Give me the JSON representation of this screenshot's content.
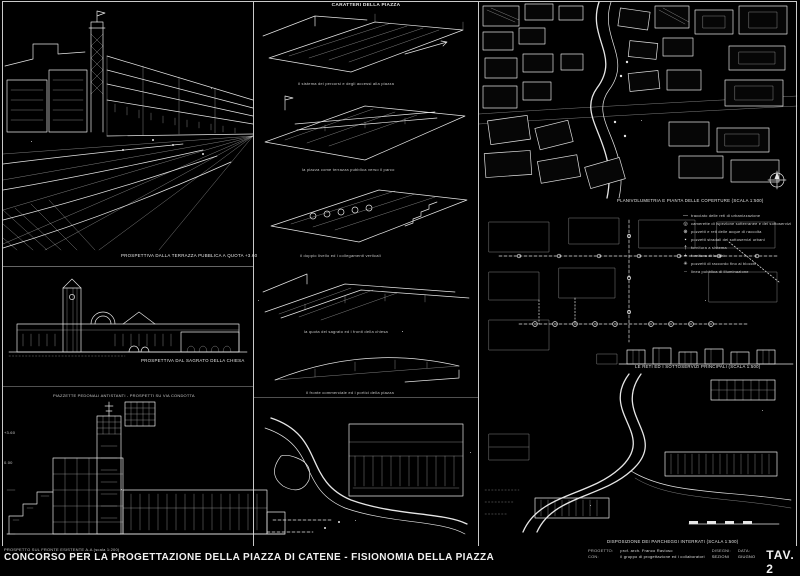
{
  "colors": {
    "background": "#000000",
    "ink": "#e6e6e6"
  },
  "middle_column": {
    "header": "CARATTERI DELLA PIAZZA",
    "sketch_captions": [
      "il sistema dei percorsi e degli accessi alla piazza",
      "la piazza come terrazza pubblica verso il parco",
      "il doppio livello ed i collegamenti verticali",
      "la quota del sagrato ed i fronti della chiesa",
      "il fronte commerciale ed i portici della piazza"
    ]
  },
  "left_column": {
    "perspective_caption": "PROSPETTIVA DALLA TERRAZZA PUBBLICA A QUOTA +3.60",
    "church_caption": "PROSPETTIVA DAL SAGRATO DELLA CHIESA",
    "elevation_note": "PIAZZETTE PEDONALI ANTISTANTI - PROSPETTI SU VIA CONDOTTA",
    "level_marks": [
      "+3.60",
      "0.00"
    ]
  },
  "right_column": {
    "map_caption": "PLANIVOLUMETRIA E PIANTA DELLE COPERTURE (scala 1:500)",
    "legend_items": [
      {
        "symbol": "—",
        "label": "tracciato delle reti di urbanizzazione"
      },
      {
        "symbol": "◎",
        "label": "camerette di ispezione sotterranee e dei sottoservizi"
      },
      {
        "symbol": "⊕",
        "label": "pozzetti e reti delle acque di raccolta"
      },
      {
        "symbol": "▪",
        "label": "pozzetti stradali dei sottoservizi urbani"
      },
      {
        "symbol": "†",
        "label": "fornitura a sistema"
      },
      {
        "symbol": "+",
        "label": "fornitura di luoghi"
      },
      {
        "symbol": "✳",
        "label": "pozzetti di raccordo fino ai blocchi"
      },
      {
        "symbol": "┄",
        "label": "linea pubblica di illuminazione"
      }
    ],
    "network_caption": "LE RETI ED I SOTTOSERVIZI PRINCIPALI (scala 1:500)",
    "parking_caption": "DISPOSIZIONE DEI PARCHEGGI INTERRATI (scala 1:500)"
  },
  "titleblock": {
    "progetto_label": "PROGETTO:",
    "progetto_value": "prof. arch. Franco Ravioso",
    "con_label": "CON:",
    "con_value": "il gruppo di progettazione ed i collaboratori",
    "disegno_label": "DISEGNI:",
    "disegno_value": "SEZIONI",
    "data_label": "DATA:",
    "data_value": "GIUGNO",
    "tav": "TAV. 2"
  },
  "footer": {
    "small_caption": "PROSPETTO SUL FRONTE ESISTENTE A-A (scala 1:200)",
    "title": "CONCORSO PER LA PROGETTAZIONE DELLA PIAZZA DI CATENE - FISIONOMIA DELLA PIAZZA"
  }
}
